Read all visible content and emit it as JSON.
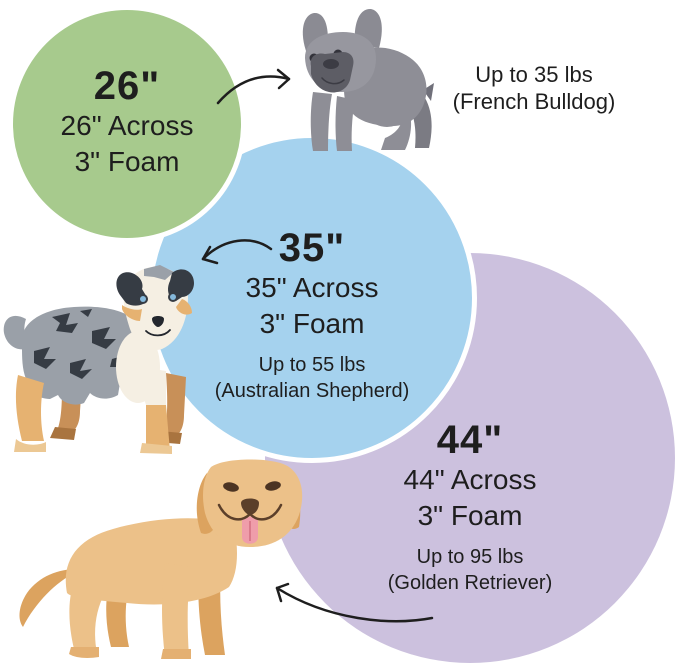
{
  "beds": [
    {
      "size": "26\"",
      "across": "26\" Across",
      "foam": "3\" Foam",
      "weight": "Up to 35 lbs",
      "breed": "(French Bulldog)",
      "circle_color": "#a7ca8d"
    },
    {
      "size": "35\"",
      "across": "35\" Across",
      "foam": "3\" Foam",
      "weight": "Up to 55 lbs",
      "breed": "(Australian Shepherd)",
      "circle_color": "#a5d2ee"
    },
    {
      "size": "44\"",
      "across": "44\" Across",
      "foam": "3\" Foam",
      "weight": "Up to 95 lbs",
      "breed": "(Golden Retriever)",
      "circle_color": "#ccc1de"
    }
  ],
  "icons": {
    "dog_26": "french-bulldog-illustration",
    "dog_35": "australian-shepherd-illustration",
    "dog_44": "golden-retriever-illustration",
    "arrow_26": "curved-arrow-to-french-bulldog",
    "arrow_35": "curved-arrow-to-australian-shepherd",
    "arrow_44": "curved-arrow-to-golden-retriever"
  },
  "colors": {
    "background": "#ffffff",
    "text": "#1e1e1e",
    "arrow": "#1e1e1e",
    "circle_border": "#ffffff"
  }
}
